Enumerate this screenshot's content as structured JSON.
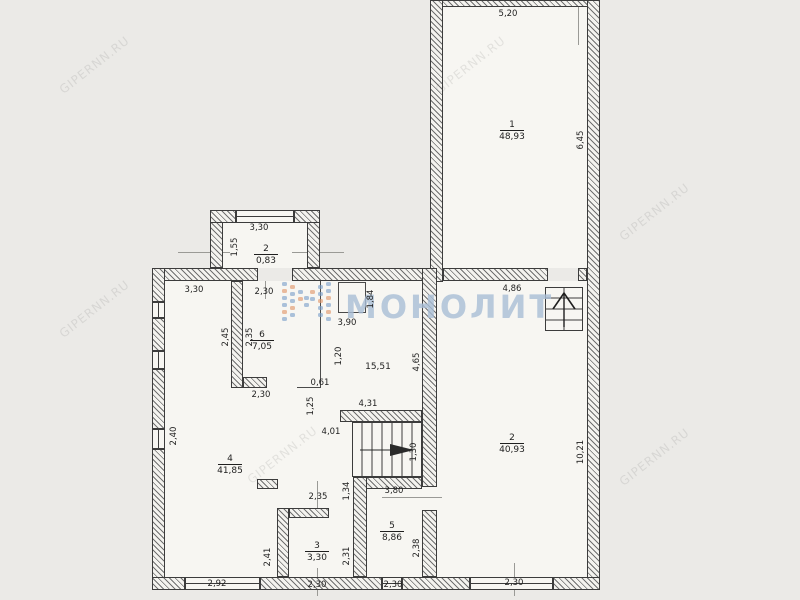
{
  "watermark": {
    "logo_text": "МОНОЛИТ",
    "site_text": "GIPERNN.RU"
  },
  "plan": {
    "rooms": [
      {
        "num": "1",
        "area": "48,93"
      },
      {
        "num": "2",
        "area": "40,93"
      },
      {
        "num": "3",
        "area": "3,30"
      },
      {
        "num": "4",
        "area": "41,85"
      },
      {
        "num": "5",
        "area": "8,86"
      },
      {
        "num": "6",
        "area": "7,05"
      },
      {
        "num": "2",
        "area": "0,83"
      },
      {
        "num": "",
        "area": "15,51"
      }
    ],
    "dims": [
      "5,20",
      "6,45",
      "3,30",
      "1,55",
      "3,30",
      "2,30",
      "4,86",
      "2,45",
      "2,35",
      "1,84",
      "3,90",
      "1,20",
      "4,65",
      "0,61",
      "1,25",
      "2,30",
      "4,31",
      "4,01",
      "1,30",
      "2,40",
      "10,21",
      "2,35",
      "1,34",
      "3,80",
      "2,41",
      "2,31",
      "2,38",
      "2,92",
      "2,30",
      "2,30",
      "2,30"
    ]
  }
}
